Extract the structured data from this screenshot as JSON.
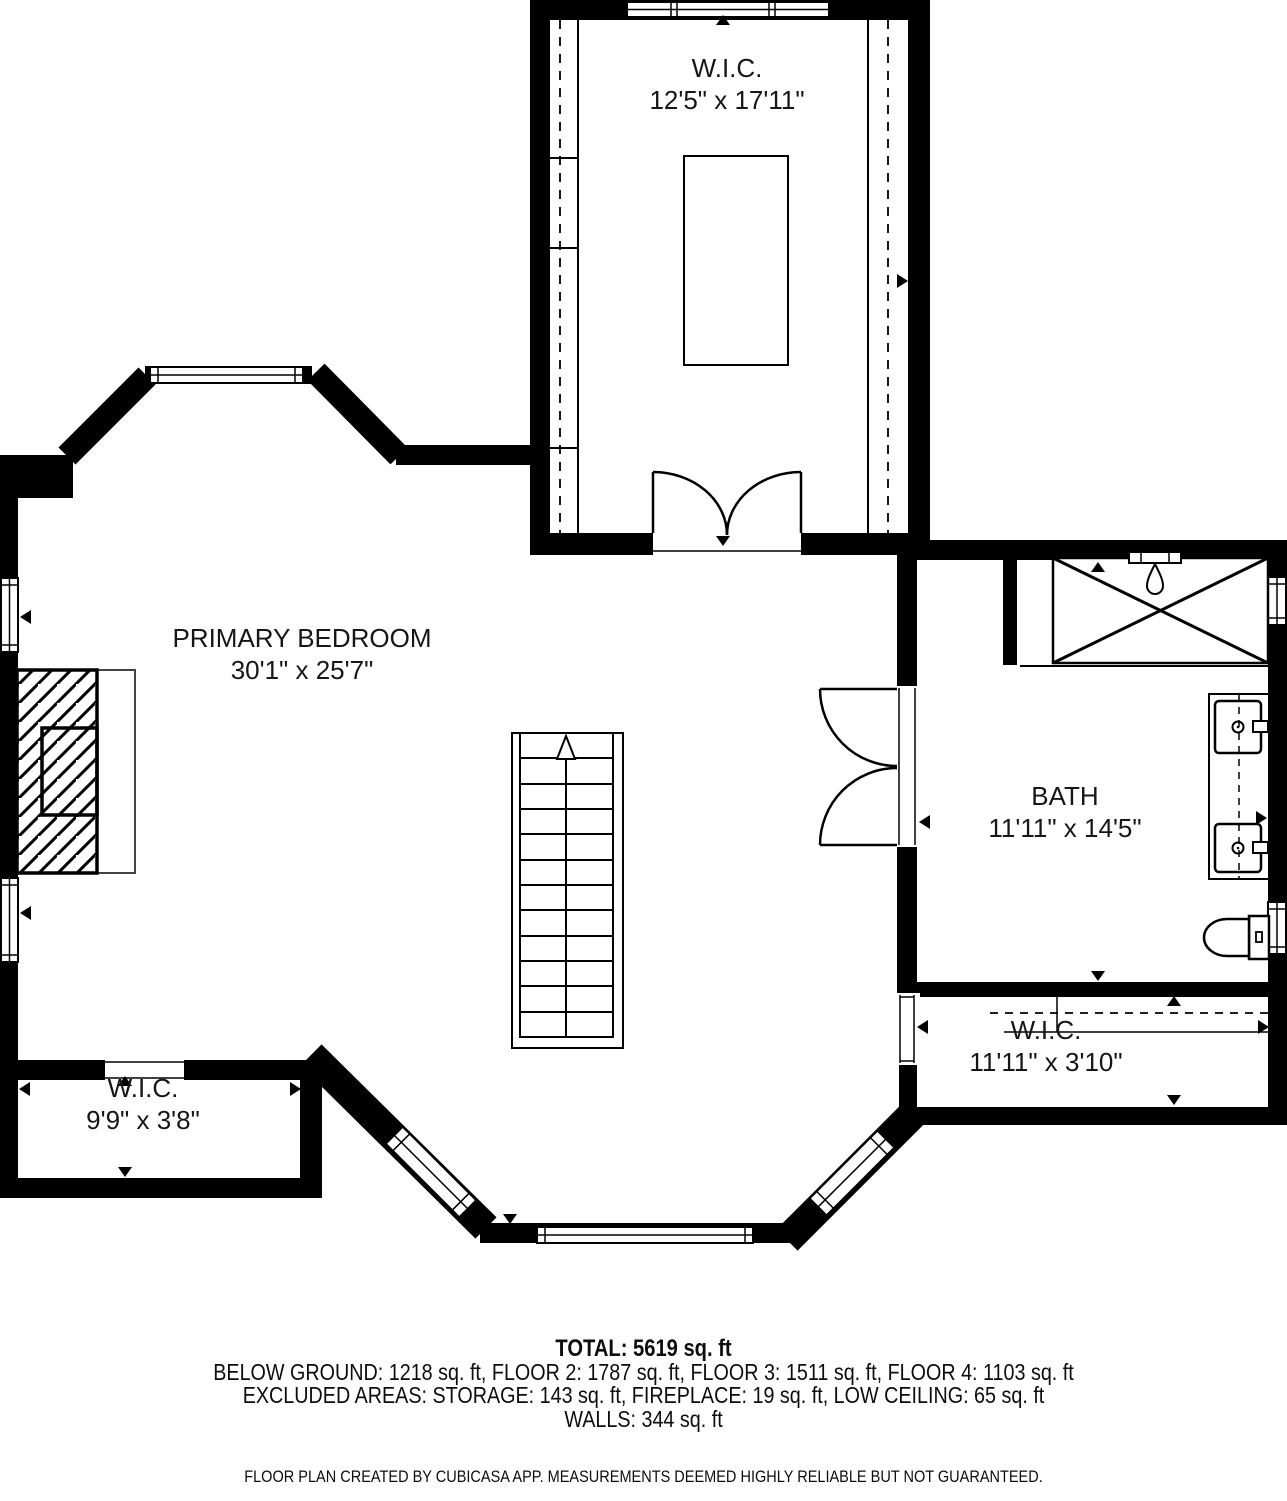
{
  "plan": {
    "rooms": [
      {
        "id": "wic-top",
        "name": "W.I.C.",
        "dimensions": "12'5\" x 17'11\""
      },
      {
        "id": "primary-bedroom",
        "name": "PRIMARY BEDROOM",
        "dimensions": "30'1\" x 25'7\""
      },
      {
        "id": "bath",
        "name": "BATH",
        "dimensions": "11'11\" x 14'5\""
      },
      {
        "id": "wic-right",
        "name": "W.I.C.",
        "dimensions": "11'11\" x 3'10\""
      },
      {
        "id": "wic-left",
        "name": "W.I.C.",
        "dimensions": "9'9\" x 3'8\""
      }
    ],
    "colors": {
      "wall": "#000000",
      "background": "#ffffff",
      "line": "#111111"
    }
  },
  "summary": {
    "total": "TOTAL: 5619 sq. ft",
    "floors": "BELOW GROUND: 1218 sq. ft, FLOOR 2: 1787 sq. ft, FLOOR 3: 1511 sq. ft, FLOOR 4: 1103 sq. ft",
    "excluded": "EXCLUDED AREAS: STORAGE: 143 sq. ft, FIREPLACE: 19 sq. ft, LOW CEILING: 65 sq. ft",
    "walls": "WALLS: 344 sq. ft"
  },
  "footer": {
    "disclaimer": "FLOOR PLAN CREATED BY CUBICASA APP. MEASUREMENTS DEEMED HIGHLY RELIABLE BUT NOT GUARANTEED."
  }
}
